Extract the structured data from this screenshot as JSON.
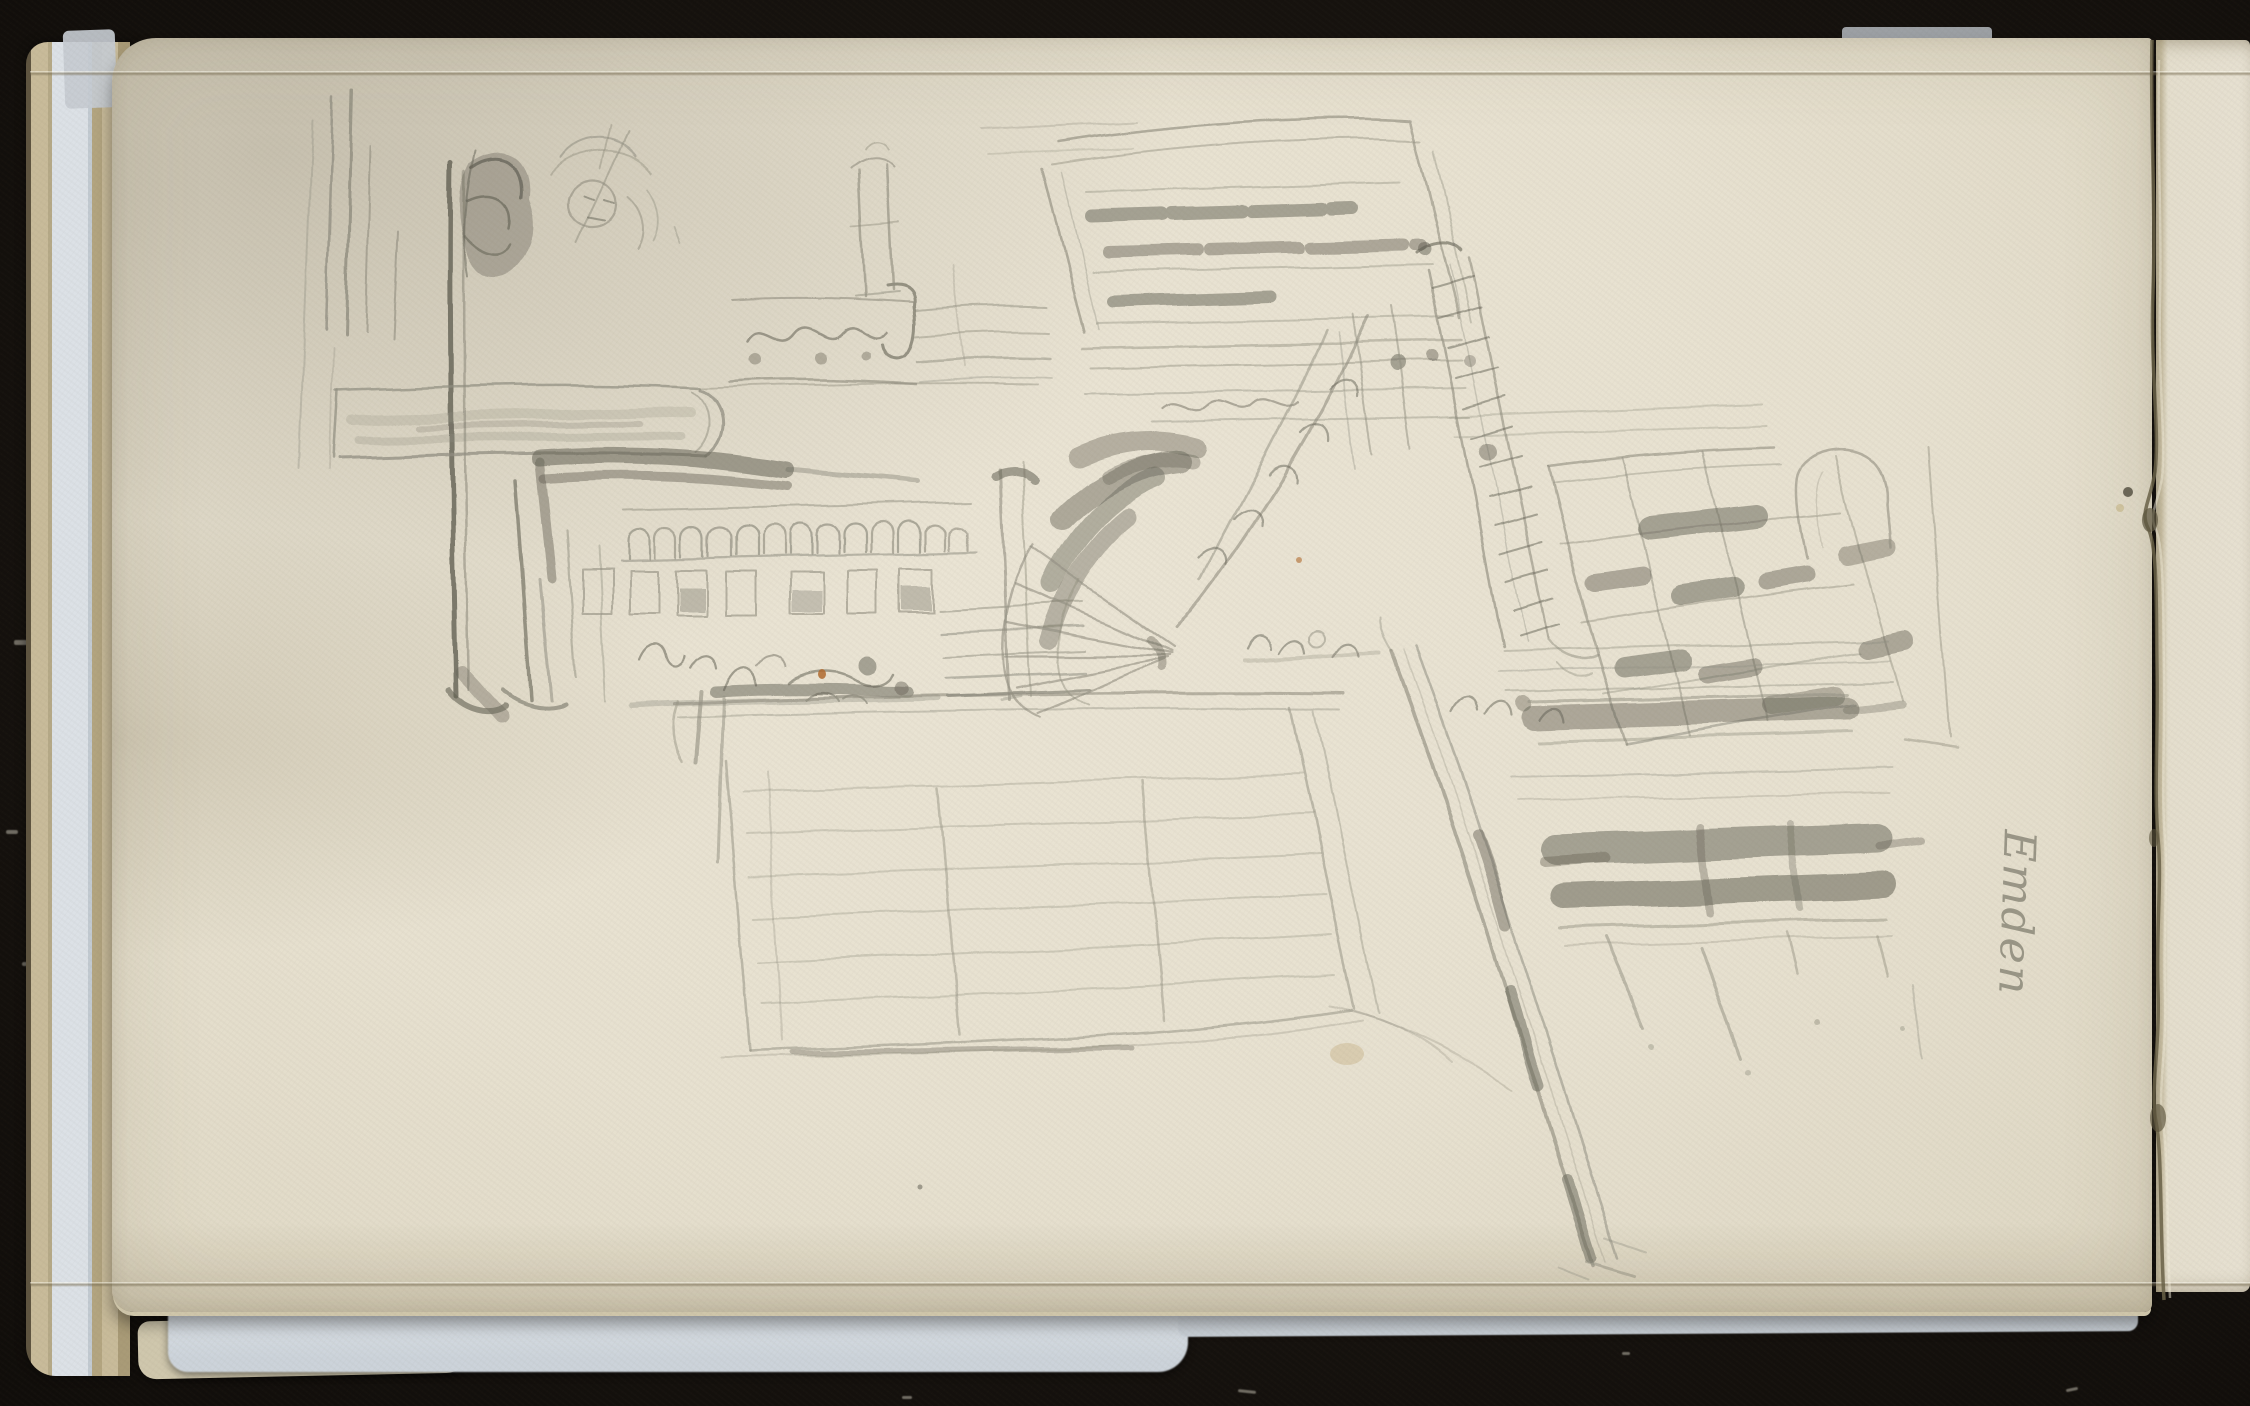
{
  "scene": {
    "type": "digitized-sketchbook-scan",
    "description": "Pencil sketch of an ornate church portal drawn sideways on a cream sketchbook page: an arched doorway with fan-shaped tympanum, carved friezes, a hatched roof, arcaded balustrade with small figures, a latticed gate, shuttered windows and a long diagonal spar. The page lies on a black backdrop with loose sheet edges and a pale blue tissue interleaf visible at left and bottom, and a torn page edge at right.",
    "inscription": {
      "text": "Emden",
      "medium": "pencil, cursive handwriting",
      "orientation": "rotated 92 degrees clockwise"
    }
  },
  "colors": {
    "background_black": "#17130f",
    "paper_cream": "#e7e1d0",
    "paper_edge": "#cfc6aa",
    "pencil": "#8d8b7d",
    "pencil_dark": "#5e5c50",
    "pencil_faint": "#b2afa0",
    "tissue_blue": "#dce1e6",
    "edge_tan": "#c8bb9a",
    "tear_brown": "#6a6148",
    "stain_brown": "#b06a2e",
    "inscription_gray": "#8a8778"
  }
}
